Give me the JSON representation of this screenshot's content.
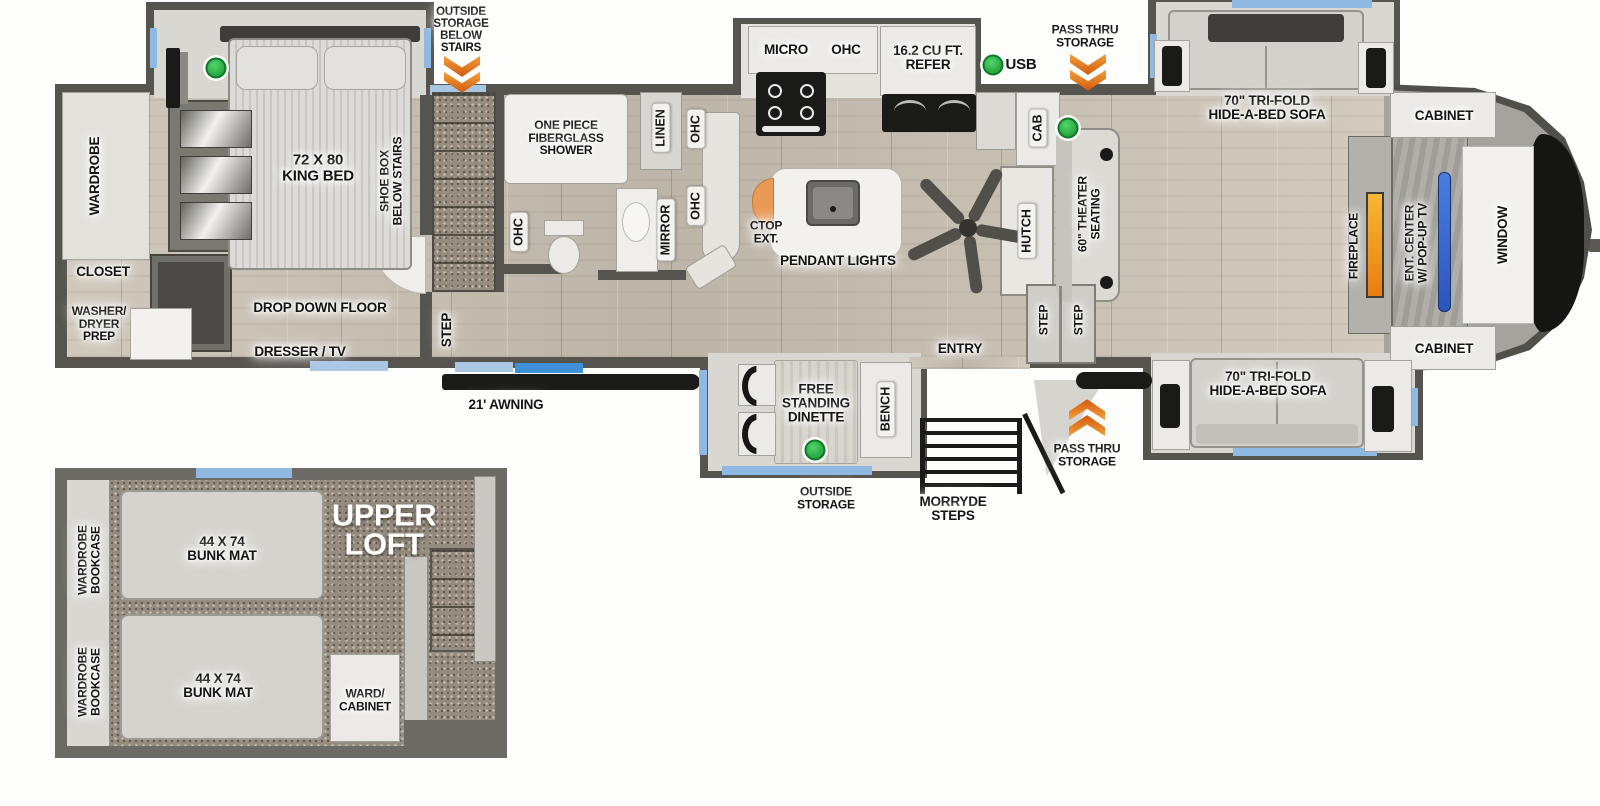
{
  "labels": {
    "outside_storage_below_stairs": "OUTSIDE\nSTORAGE\nBELOW\nSTAIRS",
    "pass_thru_storage": "PASS THRU\nSTORAGE",
    "usb": "USB",
    "micro": "MICRO",
    "ohc": "OHC",
    "refer": "16.2 CU FT.\nREFER",
    "trifold_sofa": "70\" TRI-FOLD\nHIDE-A-BED SOFA",
    "cabinet": "CABINET",
    "window": "WINDOW",
    "ent_center": "ENT. CENTER\nW/ POP-UP TV",
    "fireplace": "FIREPLACE",
    "theater_seating": "60\" THEATER\nSEATING",
    "hutch": "HUTCH",
    "cab": "CAB",
    "pendant_lights": "PENDANT LIGHTS",
    "ctop_ext": "CTOP\nEXT.",
    "king_bed": "72 X 80\nKING BED",
    "shoe_box": "SHOE BOX\nBELOW STAIRS",
    "wardrobe": "WARDROBE",
    "closet": "CLOSET",
    "washer_dryer_prep": "WASHER/\nDRYER\nPREP",
    "drop_down_floor": "DROP DOWN FLOOR",
    "dresser_tv": "DRESSER / TV",
    "step": "STEP",
    "shower": "ONE PIECE\nFIBERGLASS\nSHOWER",
    "linen": "LINEN",
    "mirror": "MIRROR",
    "awning": "21' AWNING",
    "free_standing_dinette": "FREE\nSTANDING\nDINETTE",
    "bench": "BENCH",
    "entry": "ENTRY",
    "outside_storage": "OUTSIDE\nSTORAGE",
    "morryde_steps": "MORRYDE\nSTEPS",
    "upper_loft": "UPPER\nLOFT",
    "bunk_mat": "44 X 74\nBUNK MAT",
    "wardrobe_bookcase": "WARDROBE\nBOOKCASE",
    "ward_cabinet": "WARD/\nCABINET"
  },
  "colors": {
    "chevron_orange": "#e8781e",
    "usb_green": "#2fae46",
    "window_blue": "#8fb9e2",
    "bright_window_blue": "#3f8fd9",
    "tv_blue": "#3c68cc",
    "fireplace_orange": "#f0941f",
    "wall_gray": "#56544e"
  }
}
